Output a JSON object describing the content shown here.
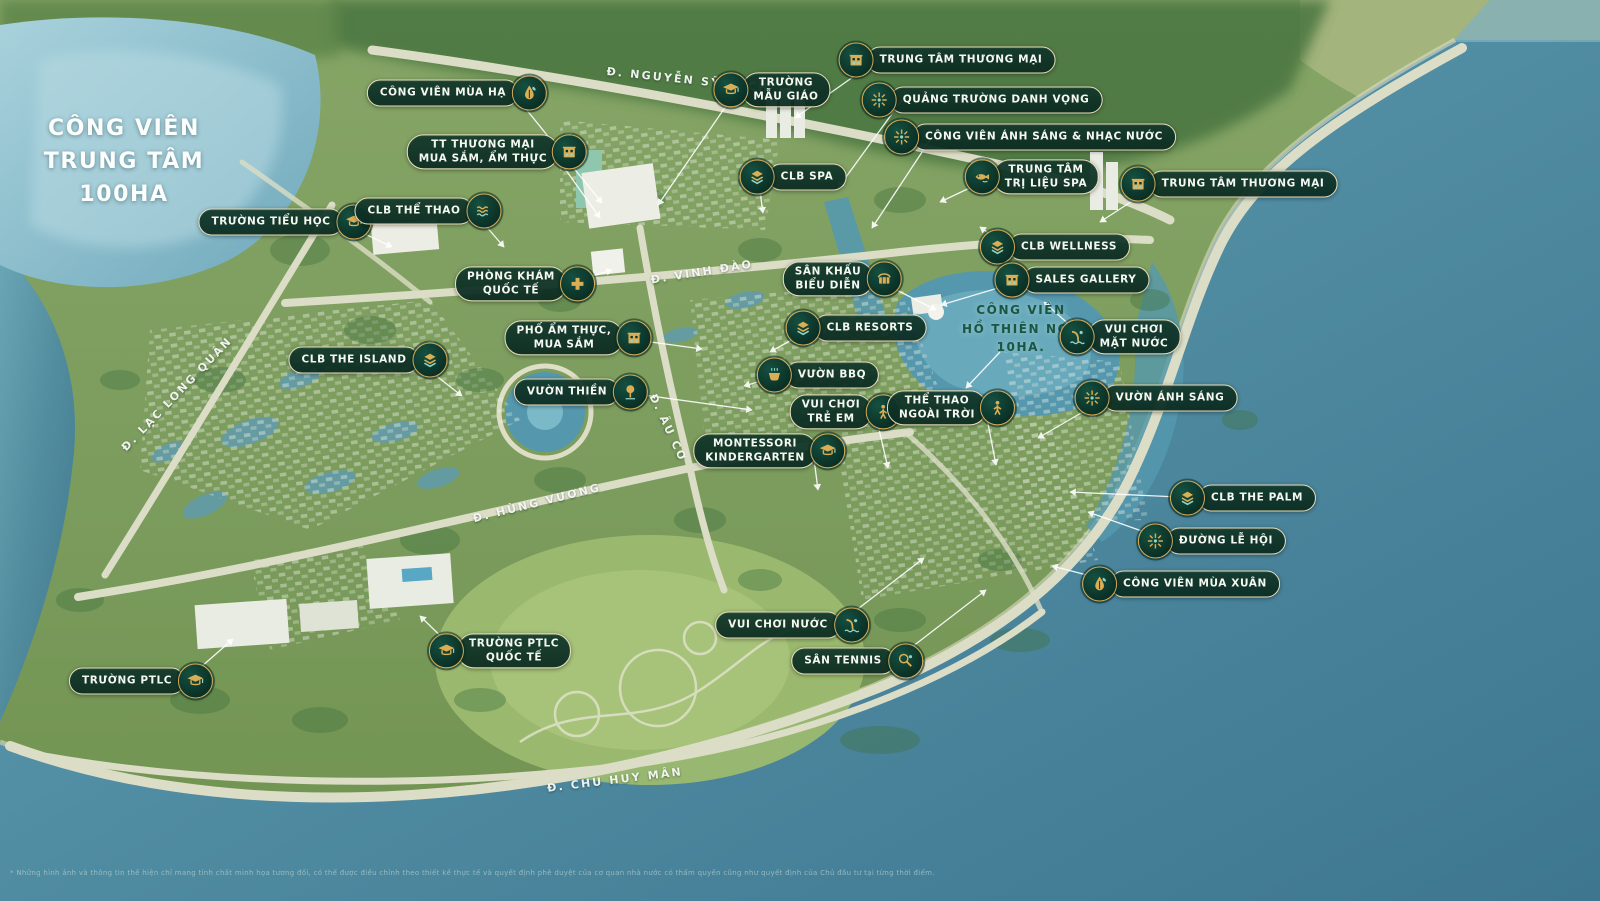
{
  "title": {
    "text": "CÔNG VIÊN\nTRUNG TÂM\n100HA"
  },
  "colors": {
    "pill_bg": "#0e382b",
    "pill_border": "#e9dfba",
    "pill_text": "#f5f7f1",
    "icon_gold": "#d9ae55",
    "icon_teal": "#8fd4c6",
    "badge_bg": "#0c342a",
    "water": "#4f8ba1",
    "lake": "#8fc0cf",
    "land": "#7d9d5f",
    "lake_label_text": "#1a5643",
    "road_label_text": "#f8faf5",
    "leader_line": "#ffffff"
  },
  "markers": [
    {
      "id": "cong-vien-mua-ha",
      "text": "CÔNG VIÊN MÙA HẠ",
      "icon": "leaf",
      "side": "right",
      "x": 457,
      "y": 93,
      "ax": 513,
      "ay": 93,
      "tx": 602,
      "ty": 203
    },
    {
      "id": "truong-mau-giao",
      "text": "TRƯỜNG\nMẪU GIÁO",
      "icon": "cap",
      "side": "left",
      "x": 772,
      "y": 90,
      "ax": 737,
      "ay": 90,
      "tx": 658,
      "ty": 205
    },
    {
      "id": "trung-tam-thuong-mai-bac",
      "text": "TRUNG TÂM THƯƠNG MẠI",
      "icon": "mall",
      "side": "left",
      "x": 947,
      "y": 60,
      "ax": 877,
      "ay": 60,
      "tx": 795,
      "ty": 118
    },
    {
      "id": "quang-truong-danh-vong",
      "text": "QUẢNG TRƯỜNG DANH VỌNG",
      "icon": "spark",
      "side": "left",
      "x": 982,
      "y": 100,
      "ax": 902,
      "ay": 100,
      "tx": 838,
      "ty": 188
    },
    {
      "id": "cong-vien-anh-sang-nhac-nuoc",
      "text": "CÔNG VIÊN ÁNH SÁNG & NHẠC NƯỚC",
      "icon": "spark",
      "side": "left",
      "x": 1030,
      "y": 137,
      "ax": 932,
      "ay": 137,
      "tx": 872,
      "ty": 228
    },
    {
      "id": "tt-thuong-mai-mua-sam",
      "text": "TT THƯƠNG MẠI\nMUA SẮM, ẨM THỰC",
      "icon": "mall",
      "side": "right",
      "x": 497,
      "y": 152,
      "ax": 553,
      "ay": 152,
      "tx": 600,
      "ty": 218
    },
    {
      "id": "clb-spa",
      "text": "CLB SPA",
      "icon": "layers",
      "side": "left",
      "x": 793,
      "y": 177,
      "ax": 758,
      "ay": 177,
      "tx": 763,
      "ty": 213
    },
    {
      "id": "trung-tam-tri-lieu-spa",
      "text": "TRUNG TÂM\nTRỊ LIỆU SPA",
      "icon": "fish",
      "side": "left",
      "x": 1032,
      "y": 177,
      "ax": 993,
      "ay": 177,
      "tx": 940,
      "ty": 202
    },
    {
      "id": "trung-tam-thuong-mai-dong",
      "text": "TRUNG TÂM THƯƠNG MẠI",
      "icon": "mall",
      "side": "left",
      "x": 1229,
      "y": 184,
      "ax": 1160,
      "ay": 183,
      "tx": 1100,
      "ty": 222
    },
    {
      "id": "truong-tieu-hoc",
      "text": "TRƯỜNG TIỂU HỌC",
      "icon": "cap",
      "side": "right",
      "x": 285,
      "y": 222,
      "ax": 340,
      "ay": 222,
      "tx": 392,
      "ty": 247
    },
    {
      "id": "clb-the-thao",
      "text": "CLB THỂ THAO",
      "icon": "waves",
      "side": "right",
      "x": 428,
      "y": 211,
      "ax": 472,
      "ay": 210,
      "tx": 504,
      "ty": 247
    },
    {
      "id": "phong-kham-quoc-te",
      "text": "PHÒNG KHÁM\nQUỐC TẾ",
      "icon": "cross",
      "side": "right",
      "x": 525,
      "y": 284,
      "ax": 567,
      "ay": 284,
      "tx": 612,
      "ty": 270
    },
    {
      "id": "san-khau-bieu-dien",
      "text": "SÂN KHẤU\nBIỂU DIỄN",
      "icon": "stage",
      "side": "right",
      "x": 842,
      "y": 279,
      "ax": 875,
      "ay": 279,
      "tx": 936,
      "ty": 310
    },
    {
      "id": "clb-resorts",
      "text": "CLB RESORTS",
      "icon": "layers",
      "side": "left",
      "x": 856,
      "y": 328,
      "ax": 813,
      "ay": 328,
      "tx": 770,
      "ty": 352
    },
    {
      "id": "cong-vien-ho-thien-nga",
      "text": "CÔNG VIÊN\nHỒ THIÊN NGA\n10HA.",
      "plain": true,
      "x": 1021,
      "y": 329,
      "ax": 1000,
      "ay": 352,
      "tx": 966,
      "ty": 388
    },
    {
      "id": "vui-choi-mat-nuoc",
      "text": "VUI CHƠI\nMẶT NƯỚC",
      "icon": "aqua",
      "side": "left",
      "x": 1120,
      "y": 337,
      "ax": 1083,
      "ay": 337,
      "tx": 1044,
      "ty": 302
    },
    {
      "id": "clb-wellness",
      "text": "CLB WELLNESS",
      "icon": "layers",
      "side": "left",
      "x": 1055,
      "y": 247,
      "ax": 1008,
      "ay": 247,
      "tx": 980,
      "ty": 227
    },
    {
      "id": "sales-gallery",
      "text": "SALES GALLERY",
      "icon": "mall",
      "side": "left",
      "x": 1072,
      "y": 280,
      "ax": 1025,
      "ay": 280,
      "tx": 941,
      "ty": 305
    },
    {
      "id": "pho-am-thuc-mua-sam",
      "text": "PHỐ ẨM THỰC,\nMUA SẮM",
      "icon": "mall",
      "side": "right",
      "x": 578,
      "y": 338,
      "ax": 622,
      "ay": 338,
      "tx": 702,
      "ty": 349
    },
    {
      "id": "clb-the-island",
      "text": "CLB THE ISLAND",
      "icon": "layers",
      "side": "right",
      "x": 368,
      "y": 360,
      "ax": 416,
      "ay": 360,
      "tx": 462,
      "ty": 396
    },
    {
      "id": "vuon-thien",
      "text": "VƯỜN THIỀN",
      "icon": "tree",
      "side": "right",
      "x": 581,
      "y": 392,
      "ax": 622,
      "ay": 392,
      "tx": 752,
      "ty": 410
    },
    {
      "id": "vuon-bbq",
      "text": "VƯỜN BBQ",
      "icon": "pot",
      "side": "left",
      "x": 818,
      "y": 375,
      "ax": 782,
      "ay": 375,
      "tx": 744,
      "ty": 386
    },
    {
      "id": "vui-choi-tre-em",
      "text": "VUI CHƠI\nTRẺ EM",
      "icon": "figure",
      "side": "right",
      "x": 845,
      "y": 412,
      "ax": 875,
      "ay": 412,
      "tx": 888,
      "ty": 468
    },
    {
      "id": "the-thao-ngoai-troi",
      "text": "THỂ THAO\nNGOÀI TRỜI",
      "icon": "figure",
      "side": "right",
      "x": 951,
      "y": 408,
      "ax": 985,
      "ay": 408,
      "tx": 996,
      "ty": 465
    },
    {
      "id": "vuon-anh-sang",
      "text": "VƯỜN ÁNH SÁNG",
      "icon": "spark",
      "side": "left",
      "x": 1156,
      "y": 398,
      "ax": 1107,
      "ay": 398,
      "tx": 1038,
      "ty": 438
    },
    {
      "id": "montessori-kindergarten",
      "text": "MONTESSORI\nKINDERGARTEN",
      "icon": "cap",
      "side": "right",
      "x": 769,
      "y": 451,
      "ax": 813,
      "ay": 451,
      "tx": 818,
      "ty": 490
    },
    {
      "id": "clb-the-palm",
      "text": "CLB THE PALM",
      "icon": "layers",
      "side": "left",
      "x": 1243,
      "y": 498,
      "ax": 1200,
      "ay": 498,
      "tx": 1070,
      "ty": 492
    },
    {
      "id": "duong-le-hoi",
      "text": "ĐƯỜNG LỄ HỘI",
      "icon": "spark",
      "side": "left",
      "x": 1212,
      "y": 541,
      "ax": 1167,
      "ay": 540,
      "tx": 1088,
      "ty": 512
    },
    {
      "id": "cong-vien-mua-xuan",
      "text": "CÔNG VIÊN MÙA XUÂN",
      "icon": "leaf",
      "side": "left",
      "x": 1181,
      "y": 584,
      "ax": 1118,
      "ay": 583,
      "tx": 1052,
      "ty": 566
    },
    {
      "id": "vui-choi-nuoc",
      "text": "VUI CHƠI NƯỚC",
      "icon": "aqua",
      "side": "right",
      "x": 792,
      "y": 625,
      "ax": 837,
      "ay": 625,
      "tx": 924,
      "ty": 558
    },
    {
      "id": "san-tennis",
      "text": "SÂN TENNIS",
      "icon": "racket",
      "side": "right",
      "x": 857,
      "y": 661,
      "ax": 895,
      "ay": 660,
      "tx": 986,
      "ty": 590
    },
    {
      "id": "truong-ptlc",
      "text": "TRƯỜNG PTLC",
      "icon": "cap",
      "side": "right",
      "x": 141,
      "y": 681,
      "ax": 185,
      "ay": 681,
      "tx": 233,
      "ty": 639
    },
    {
      "id": "truong-ptlc-quoc-te",
      "text": "TRƯỜNG PTLC\nQUỐC TẾ",
      "icon": "cap",
      "side": "left",
      "x": 500,
      "y": 651,
      "ax": 455,
      "ay": 650,
      "tx": 420,
      "ty": 616
    }
  ],
  "roads": [
    {
      "id": "nguyen-sy-sach",
      "text": "Đ. NGUYỄN SỸ SÁCH",
      "x": 688,
      "y": 80,
      "angle": 6
    },
    {
      "id": "vinh-dao",
      "text": "Đ. VINH ĐÀO",
      "x": 702,
      "y": 272,
      "angle": -9
    },
    {
      "id": "au-co",
      "text": "Đ. ÂU CƠ",
      "x": 668,
      "y": 428,
      "angle": 65
    },
    {
      "id": "hung-vuong",
      "text": "Đ. HÙNG VƯƠNG",
      "x": 537,
      "y": 503,
      "angle": -14
    },
    {
      "id": "chu-huy-man",
      "text": "Đ. CHU HUY MÂN",
      "x": 615,
      "y": 780,
      "angle": -7
    },
    {
      "id": "lac-long-quan",
      "text": "Đ. LẠC LONG QUÂN",
      "x": 177,
      "y": 394,
      "angle": -46
    }
  ],
  "disclaimer": "* Những hình ảnh và thông tin thể hiện chỉ mang tính chất minh họa tương đối, có thể được điều chỉnh theo thiết kế thực tế và quyết định phê duyệt của cơ quan nhà nước có thẩm quyền cũng như quyết định của Chủ đầu tư tại từng thời điểm."
}
